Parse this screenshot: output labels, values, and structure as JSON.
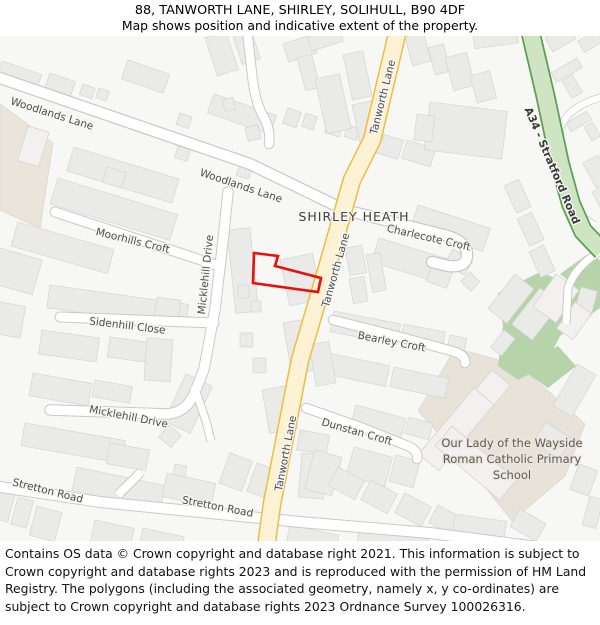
{
  "header": {
    "title": "88, TANWORTH LANE, SHIRLEY, SOLIHULL, B90 4DF",
    "subtitle": "Map shows position and indicative extent of the property."
  },
  "map": {
    "place_label": "SHIRLEY HEATH",
    "school_label": {
      "line1": "Our Lady of the Wayside",
      "line2": "Roman Catholic Primary",
      "line3": "School"
    },
    "streets": {
      "woodlands_lane": "Woodlands Lane",
      "tanworth_lane": "Tanworth Lane",
      "a34": "A34 - Stratford Road",
      "charlecote_croft": "Charlecote Croft",
      "moorhills_croft": "Moorhills Croft",
      "micklehill_drive": "Micklehill Drive",
      "sidenhill_close": "Sidenhill Close",
      "stretton_road": "Stretton Road",
      "bearley_croft": "Bearley Croft",
      "dunstan_croft": "Dunstan Croft"
    },
    "colors": {
      "property_outline": "#e8100c",
      "main_road_fill": "#fdf2d3",
      "main_road_casing": "#eebc45",
      "a_road_fill": "#cfe4c3",
      "a_road_casing": "#5aa050",
      "building_fill": "#eaeae8",
      "green_area": "#b7d3aa",
      "school_grounds": "#e8e2d8",
      "commercial_area": "#eae4da"
    }
  },
  "footer": {
    "text": "Contains OS data © Crown copyright and database right 2021. This information is subject to Crown copyright and database rights 2023 and is reproduced with the permission of HM Land Registry. The polygons (including the associated geometry, namely x, y co-ordinates) are subject to Crown copyright and database rights 2023 Ordnance Survey 100026316."
  }
}
